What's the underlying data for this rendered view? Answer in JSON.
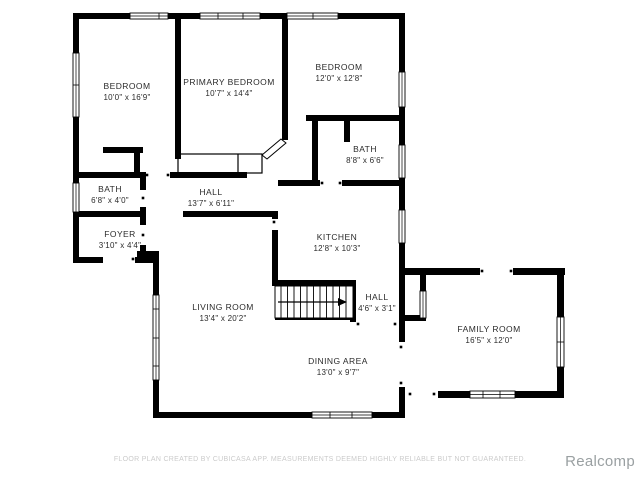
{
  "rooms": [
    {
      "id": "bedroom-1",
      "name": "BEDROOM",
      "dims": "10'0\" x 16'9\""
    },
    {
      "id": "primary-bedroom",
      "name": "PRIMARY BEDROOM",
      "dims": "10'7\" x 14'4\""
    },
    {
      "id": "bedroom-2",
      "name": "BEDROOM",
      "dims": "12'0\" x 12'8\""
    },
    {
      "id": "bath-upper",
      "name": "BATH",
      "dims": "8'8\" x 6'6\""
    },
    {
      "id": "bath-left",
      "name": "BATH",
      "dims": "6'8\" x 4'0\""
    },
    {
      "id": "hall-main",
      "name": "HALL",
      "dims": "13'7\" x 6'11\""
    },
    {
      "id": "foyer",
      "name": "FOYER",
      "dims": "3'10\" x 4'4\""
    },
    {
      "id": "kitchen",
      "name": "KITCHEN",
      "dims": "12'8\" x 10'3\""
    },
    {
      "id": "hall-small",
      "name": "HALL",
      "dims": "4'6\" x 3'1\""
    },
    {
      "id": "living-room",
      "name": "LIVING ROOM",
      "dims": "13'4\" x 20'2\""
    },
    {
      "id": "dining-area",
      "name": "DINING AREA",
      "dims": "13'0\" x 9'7\""
    },
    {
      "id": "family-room",
      "name": "FAMILY ROOM",
      "dims": "16'5\" x 12'0\""
    }
  ],
  "footer": {
    "disclaimer": "FLOOR PLAN CREATED BY CUBICASA APP. MEASUREMENTS DEEMED HIGHLY RELIABLE BUT NOT GUARANTEED."
  },
  "watermark": "Realcomp",
  "colors": {
    "wall": "#000000",
    "background": "#ffffff",
    "label": "#2b2b2b",
    "disclaimer": "#cbcbcb",
    "watermark": "#9aa0a2"
  }
}
